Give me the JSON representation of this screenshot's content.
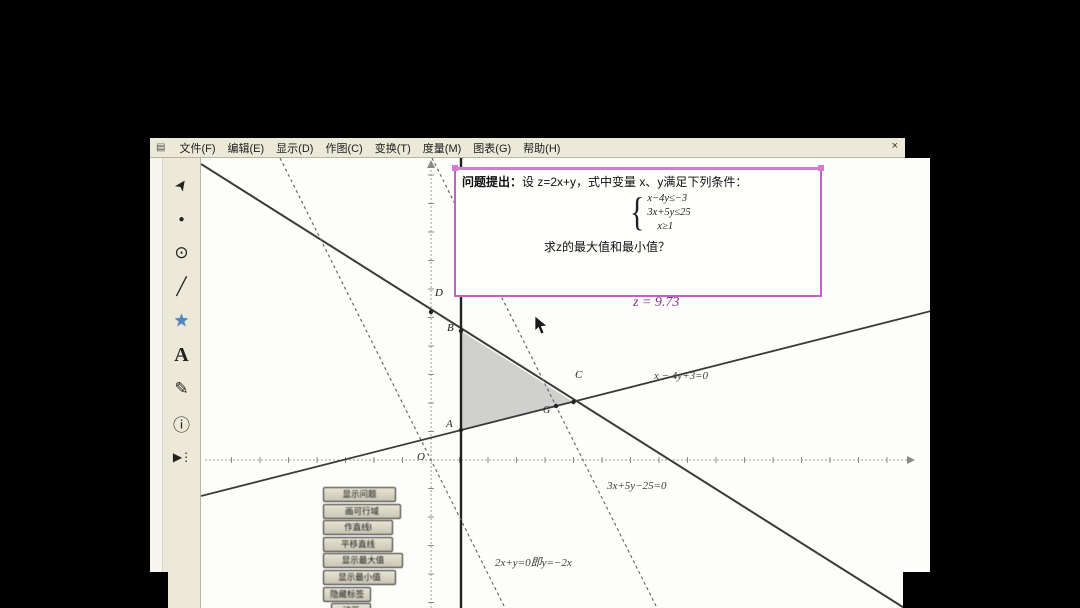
{
  "menu": {
    "app_icon": "▤",
    "items": [
      "文件(F)",
      "编辑(E)",
      "显示(D)",
      "作图(C)",
      "变换(T)",
      "度量(M)",
      "图表(G)",
      "帮助(H)"
    ],
    "close": "×"
  },
  "toolbox": {
    "tools": [
      {
        "name": "selection-arrow-tool",
        "glyph": "➤"
      },
      {
        "name": "point-tool",
        "glyph": "●"
      },
      {
        "name": "compass-circle-tool",
        "glyph": "⊙"
      },
      {
        "name": "straightedge-tool",
        "glyph": "╱"
      },
      {
        "name": "polygon-tool",
        "glyph": "★"
      },
      {
        "name": "text-tool",
        "glyph": "A"
      },
      {
        "name": "marker-tool",
        "glyph": "✎"
      },
      {
        "name": "information-tool",
        "glyph": "ⓘ"
      },
      {
        "name": "custom-tool",
        "glyph": "▶⋮"
      }
    ]
  },
  "problem_box": {
    "title": "问题提出：",
    "intro": "设 z=2x+y，式中变量 x、y满足下列条件：",
    "constraints": [
      "x−4y≤−3",
      "3x+5y≤25",
      "x≥1"
    ],
    "brace": "{",
    "question": "求z的最大值和最小值？"
  },
  "annotations": {
    "z_value": "z = 9.73",
    "line_x4y": "x − 4y+3=0",
    "line_3x5y": "3x+5y−25=0",
    "objective_line": "2x+y=0即y=−2x",
    "x_equals_1": "x=1"
  },
  "point_labels": {
    "O": "O",
    "A": "A",
    "B": "B",
    "C": "C",
    "D": "D",
    "G": "G"
  },
  "action_buttons": [
    "显示问题",
    "画可行域",
    "作直线l",
    "平移直线",
    "显示最大值",
    "显示最小值",
    "隐藏标签",
    "动画"
  ],
  "colors": {
    "highlight_magenta": "#c65fc6",
    "z_text_purple": "#8a2d9c",
    "chrome_beige": "#ece9d8",
    "canvas_white": "#fdfdfa",
    "polygon_tool_blue": "#4a86c8",
    "region_fill_gray": "#c4c4c4"
  }
}
